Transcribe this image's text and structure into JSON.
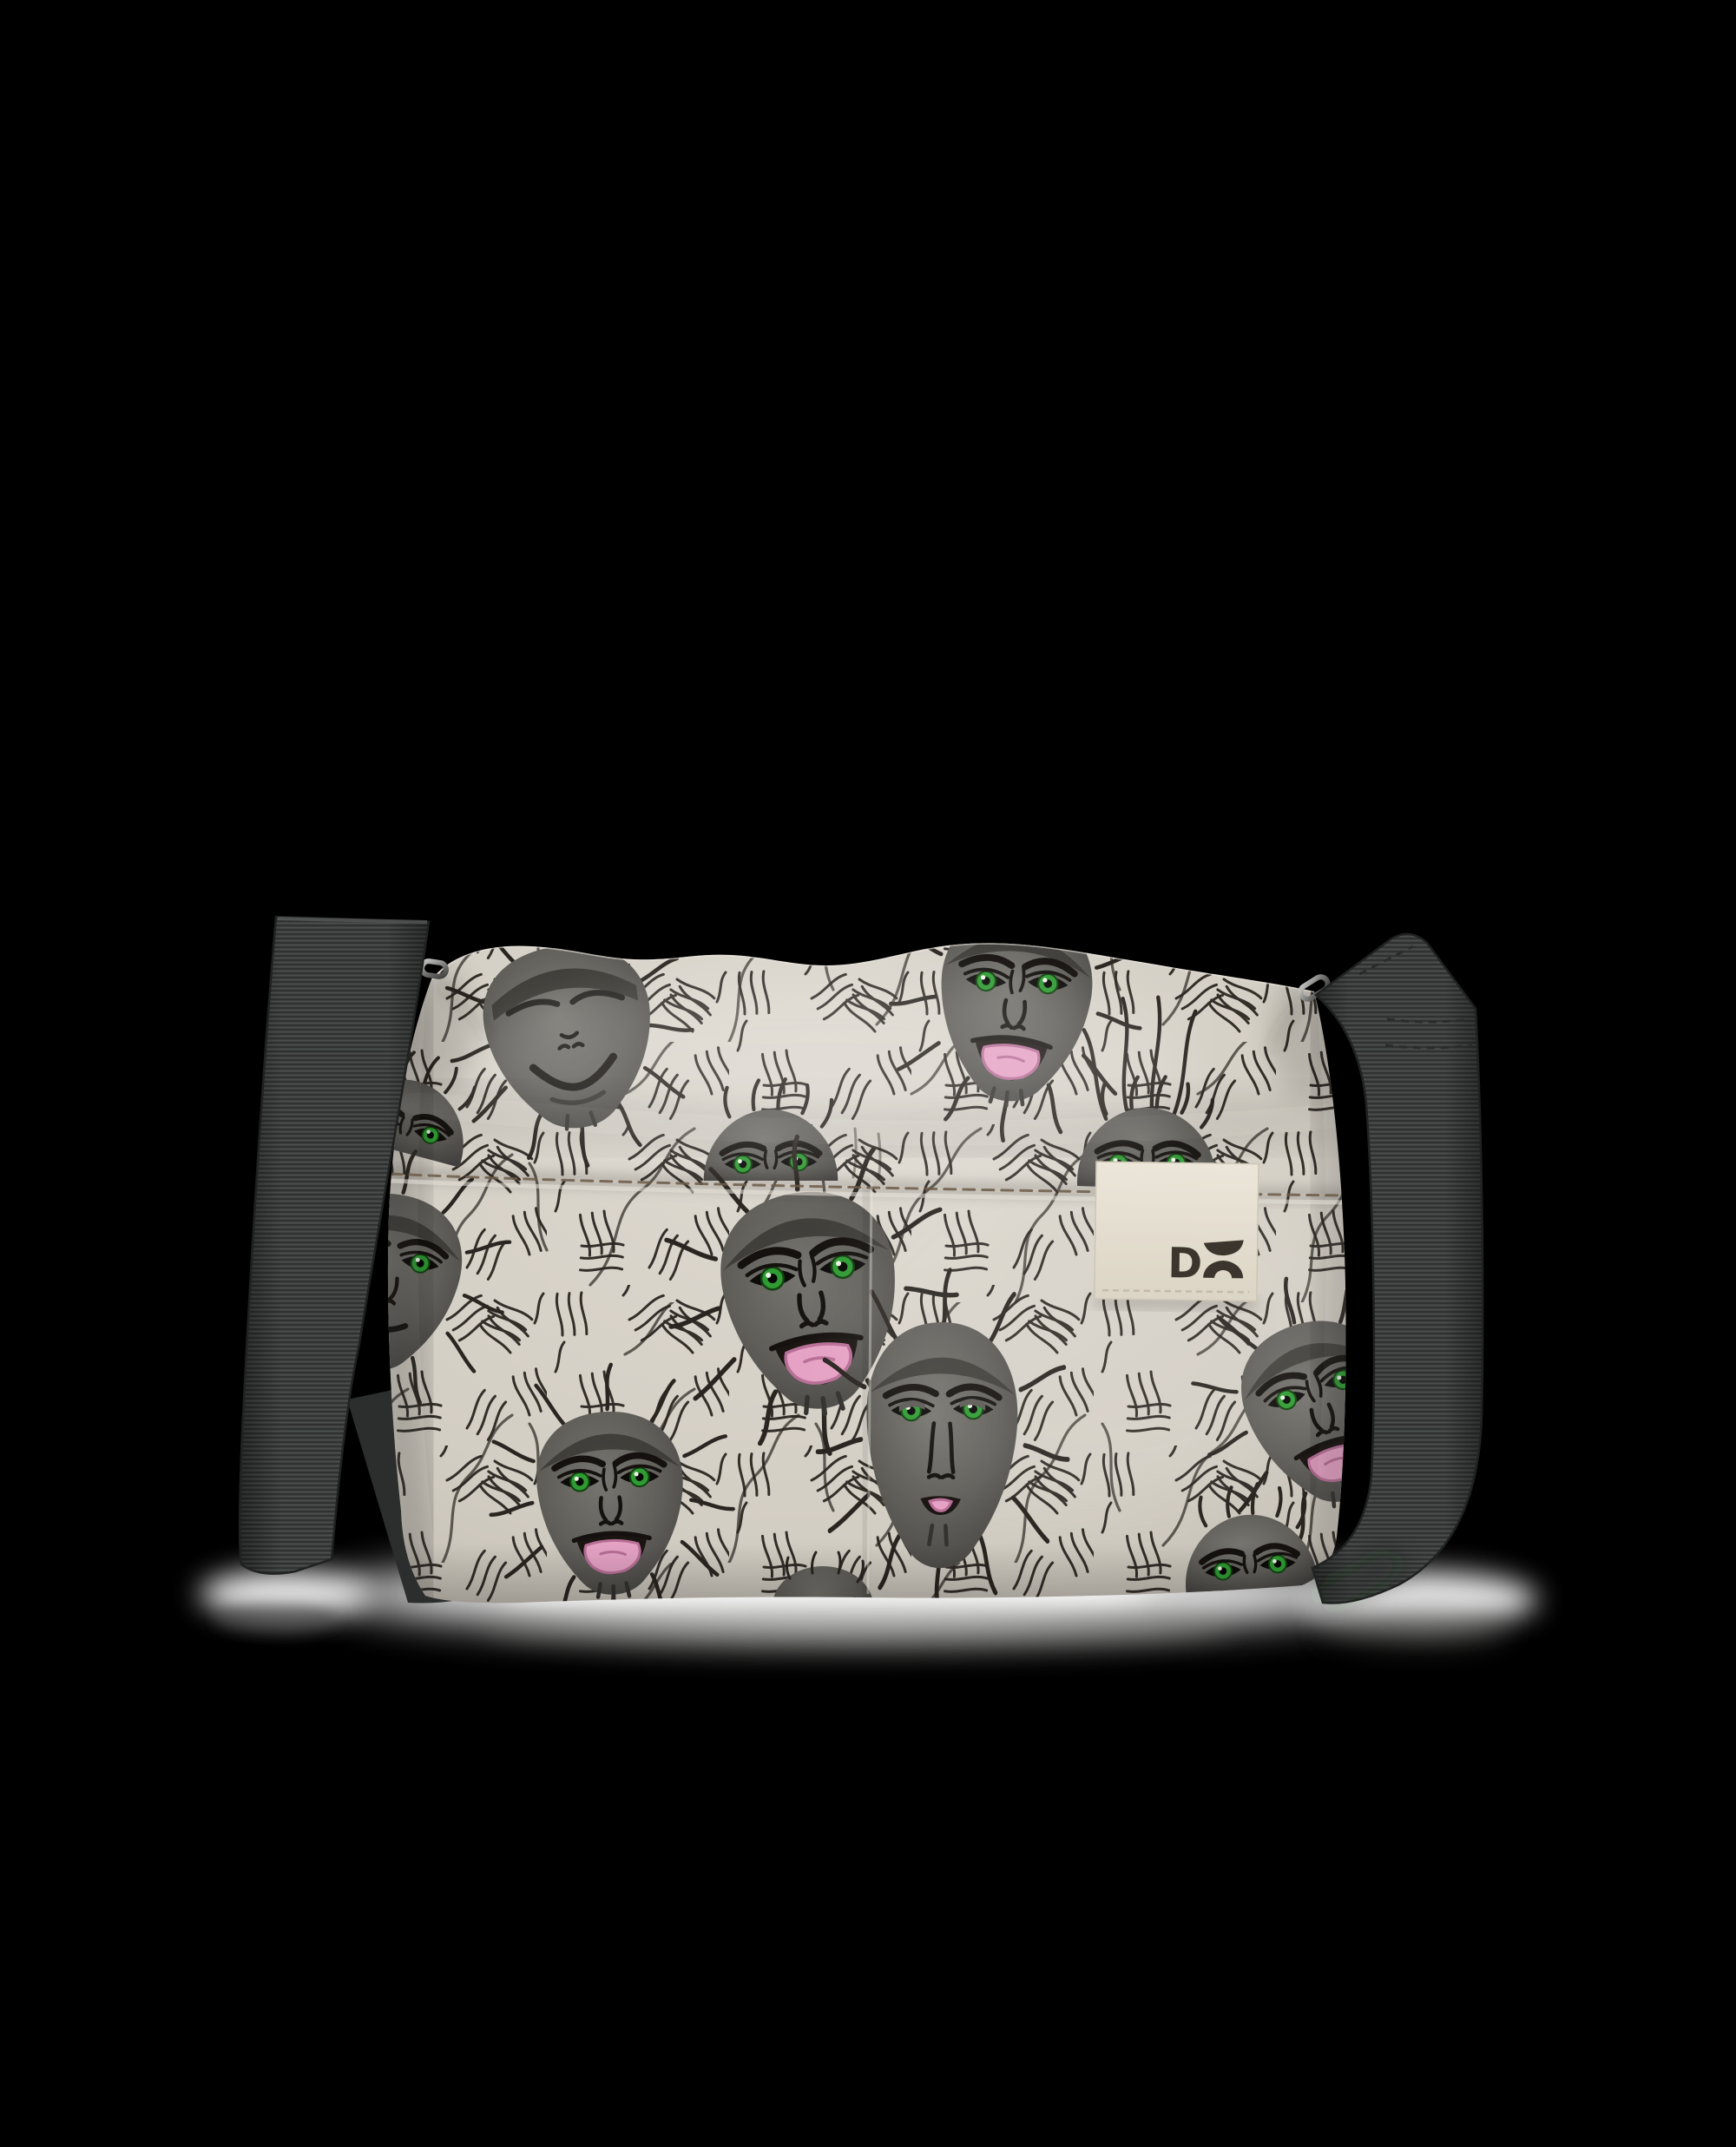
{
  "scene": {
    "description": "product-photo-crossbody-sling-bag-with-monkey-print-on-black-background"
  },
  "brand_label": {
    "logo_d": "D",
    "logo_o_icon": "smiley-o-mark"
  },
  "colors": {
    "background": "#000000",
    "fabric_light": "#ddd9d0",
    "fabric_mid": "#cfcac0",
    "fabric_dark": "#b3ada2",
    "fur_stroke": "#2a2520",
    "face_light": "#76746e",
    "face_mid": "#5e5c57",
    "face_dark": "#44423e",
    "line_black": "#14110e",
    "eye_green": "#2f9b33",
    "eye_green_dark": "#12430f",
    "tongue_pink": "#e5a2c4",
    "tongue_pink_dark": "#b86f97",
    "strap_base": "#3e4140",
    "strap_rib_dark": "#2c2f2e",
    "strap_rib_light": "#4b4e4d",
    "strap_edge": "#1f2221",
    "label_bg": "#eae4d8",
    "label_bg_dark": "#d9d2c2",
    "label_stitch": "#c2bba9",
    "logo_color": "#3b352d",
    "seam_stitch": "#6b5a48",
    "metal_light": "#c6c6c4",
    "metal_dark": "#3f3f3d",
    "shadow_white": "#ffffff"
  }
}
